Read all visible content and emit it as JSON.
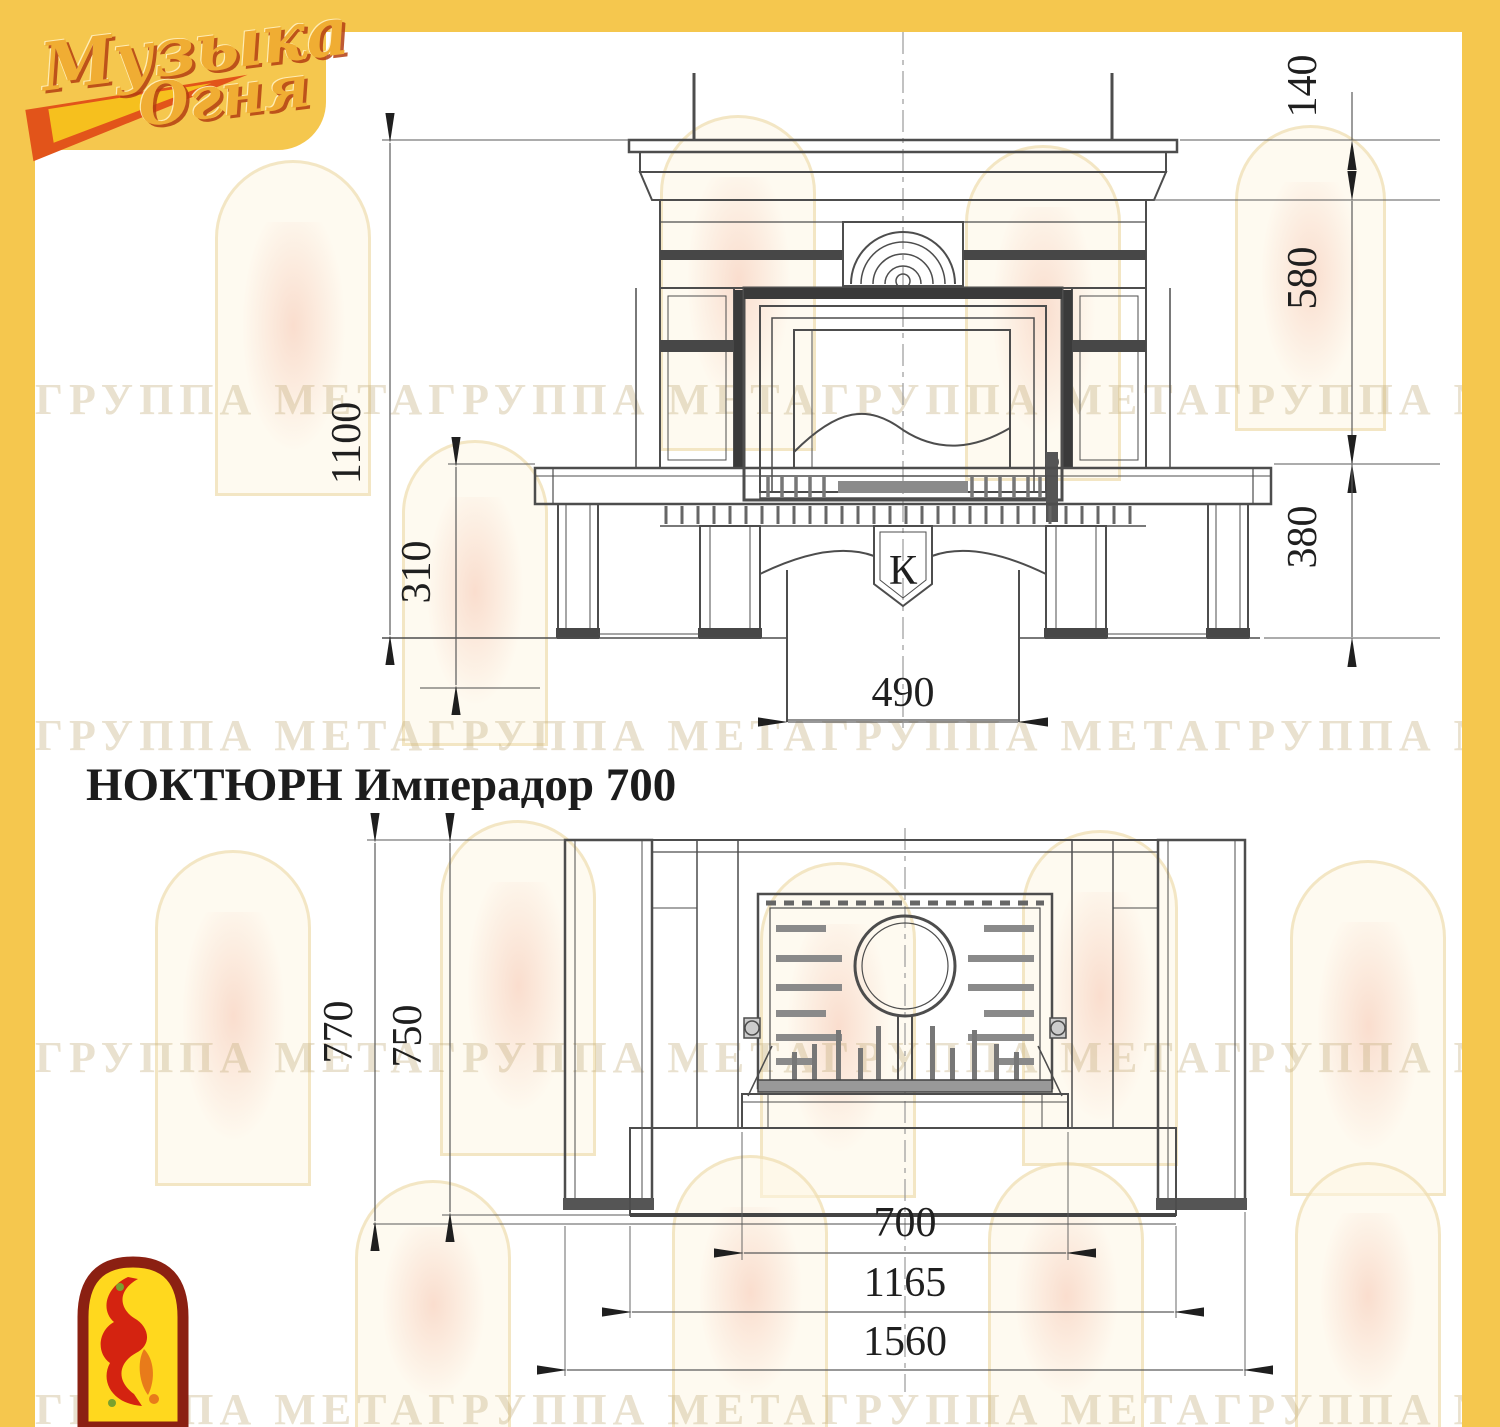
{
  "page": {
    "accent_yellow": "#f5c74e",
    "logo_gold": "#f0ad33",
    "logo_red": "#c8431a",
    "flame_red": "#d42310",
    "flame_orange": "#e87b1a"
  },
  "brand": {
    "logo_line1": "Музыка",
    "logo_line2": "Огня"
  },
  "watermark": {
    "text": "ГРУППА МЕТАГРУППА МЕТАГРУППА МЕТАГРУППА МЕТА"
  },
  "title": "НОКТЮРН Имперадор 700",
  "front_view": {
    "dim_total_height": "1100",
    "dim_hearth_height": "310",
    "dim_cornice_height": "140",
    "dim_opening_height": "580",
    "dim_base_height": "380",
    "dim_pedestal_width": "490",
    "keystone_letter": "К"
  },
  "plan_view": {
    "dim_depth_total": "770",
    "dim_depth_inner": "750",
    "dim_opening_width": "700",
    "dim_hearth_width": "1165",
    "dim_total_width": "1560"
  }
}
